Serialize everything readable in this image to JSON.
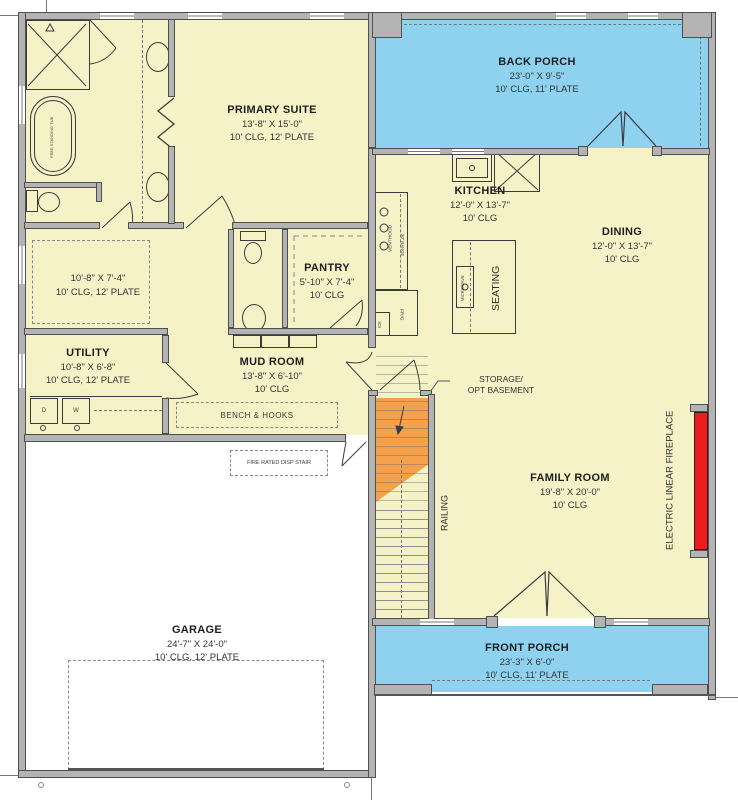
{
  "rooms": {
    "back_porch": {
      "name": "BACK PORCH",
      "dims": "23'-0\" X 9'-5\"",
      "specs": "10' CLG, 11' PLATE"
    },
    "primary_suite": {
      "name": "PRIMARY SUITE",
      "dims": "13'-8\" X 15'-0\"",
      "specs": "10' CLG, 12' PLATE"
    },
    "primary_bath": {
      "dims": "10'-8\" X 7'-4\"",
      "specs": "10' CLG, 12' PLATE"
    },
    "utility": {
      "name": "UTILITY",
      "dims": "10'-8\" X 6'-8\"",
      "specs": "10' CLG, 12' PLATE"
    },
    "mud_room": {
      "name": "MUD ROOM",
      "dims": "13'-8\" X 6'-10\"",
      "specs": "10' CLG"
    },
    "pantry": {
      "name": "PANTRY",
      "dims": "5'-10\" X 7'-4\"",
      "specs": "10' CLG"
    },
    "kitchen": {
      "name": "KITCHEN",
      "dims": "12'-0\" X 13'-7\"",
      "specs": "10' CLG"
    },
    "dining": {
      "name": "DINING",
      "dims": "12'-0\" X 13'-7\"",
      "specs": "10' CLG"
    },
    "family_room": {
      "name": "FAMILY ROOM",
      "dims": "19'-8\" X 20'-0\"",
      "specs": "10' CLG"
    },
    "garage": {
      "name": "GARAGE",
      "dims": "24'-7\" X 24'-0\"",
      "specs": "10' CLG, 12' PLATE"
    },
    "front_porch": {
      "name": "FRONT PORCH",
      "dims": "23'-3\" X 6'-0\"",
      "specs": "10' CLG, 11' PLATE"
    }
  },
  "annotations": {
    "storage_line1": "STORAGE/",
    "storage_line2": "OPT BASEMENT",
    "bench_hooks": "BENCH & HOOKS",
    "railing": "RAILING",
    "fireplace": "ELECTRIC LINEAR FIREPLACE",
    "fire_rated_stair": "FIRE RATED DISP STAIR",
    "seating": "SEATING",
    "microwave": "MICROWAVE",
    "venthood": "VENTHOOD",
    "range": "30\" RANGE",
    "frig": "FRIG",
    "ice": "ICE",
    "free_standing_tub": "FREE STANDING TUB",
    "washer": "W",
    "dryer": "D"
  },
  "colors": {
    "interior": "#f6f2c8",
    "porch": "#8ed2f0",
    "stairs": "#f5a14b",
    "fireplace": "#ee1c1c",
    "wall": "#b4b4b4",
    "line": "#3c3c3c"
  }
}
